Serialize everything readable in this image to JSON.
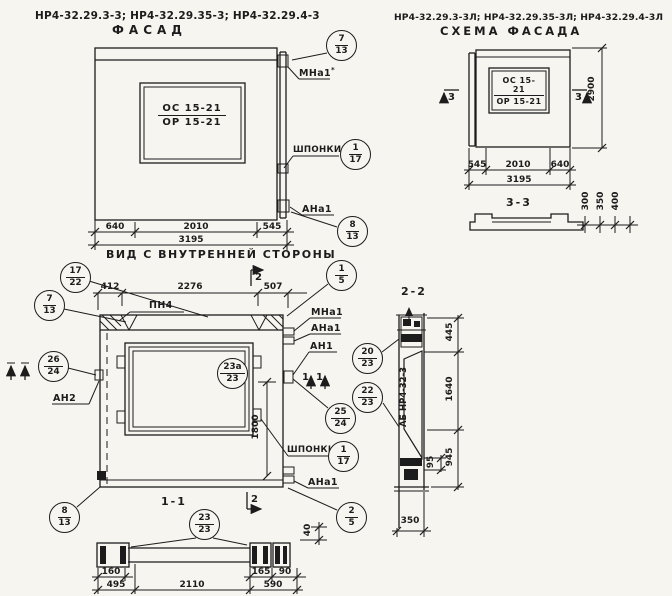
{
  "titles": {
    "left_models": "НР4-32.29.3-3; НР4-32.29.35-3; НР4-32.29.4-3",
    "left_sub": "ФАСАД",
    "right_models": "НР4-32.29.3-3Л; НР4-32.29.35-3Л; НР4-32.29.4-3Л",
    "right_sub": "СХЕМА ФАСАДА",
    "inner_view": "ВИД С ВНУТРЕННЕЙ СТОРОНЫ",
    "sec11": "1-1",
    "sec22": "2-2",
    "sec33": "3-3"
  },
  "window_mark": {
    "top": "ОС 15-21",
    "bottom": "ОР 15-21"
  },
  "labels": {
    "mna1_note": "МНа1",
    "mna1_note_sup": "*",
    "shponki": "ШПОНКИ",
    "ana1": "АНа1",
    "mna1": "МНа1",
    "an1": "АН1",
    "an2": "АН2",
    "pn4": "ПН4",
    "stamp": "АБ НР4-32-3"
  },
  "marks": {
    "s1": "1",
    "s2": "2",
    "s3": "3"
  },
  "callouts": [
    {
      "top": "7",
      "bottom": "13"
    },
    {
      "top": "1",
      "bottom": "17"
    },
    {
      "top": "8",
      "bottom": "13"
    },
    {
      "top": "17",
      "bottom": "22"
    },
    {
      "top": "7",
      "bottom": "13"
    },
    {
      "top": "26",
      "bottom": "24"
    },
    {
      "top": "8",
      "bottom": "13"
    },
    {
      "top": "1",
      "bottom": "5"
    },
    {
      "top": "20",
      "bottom": "23"
    },
    {
      "top": "22",
      "bottom": "23"
    },
    {
      "top": "25",
      "bottom": "24"
    },
    {
      "top": "23а",
      "bottom": "23"
    },
    {
      "top": "1",
      "bottom": "17"
    },
    {
      "top": "2",
      "bottom": "5"
    },
    {
      "top": "23",
      "bottom": "23"
    }
  ],
  "dims": {
    "facade": {
      "a": "640",
      "b": "2010",
      "c": "545",
      "total": "3195"
    },
    "inner_top": {
      "a": "412",
      "b": "2276",
      "c": "507"
    },
    "inner_h": "1800",
    "forty": "40",
    "profile": {
      "a": "160",
      "b": "495",
      "c": "2110",
      "d": "165",
      "e": "590",
      "f": "90"
    },
    "scheme": {
      "a": "545",
      "b": "2010",
      "c": "640",
      "total": "3195",
      "h": "2900"
    },
    "s33": {
      "a": "300",
      "b": "350",
      "c": "400"
    },
    "s22": {
      "a": "445",
      "b": "1640",
      "c": "95",
      "d": "945",
      "e": "350"
    }
  }
}
